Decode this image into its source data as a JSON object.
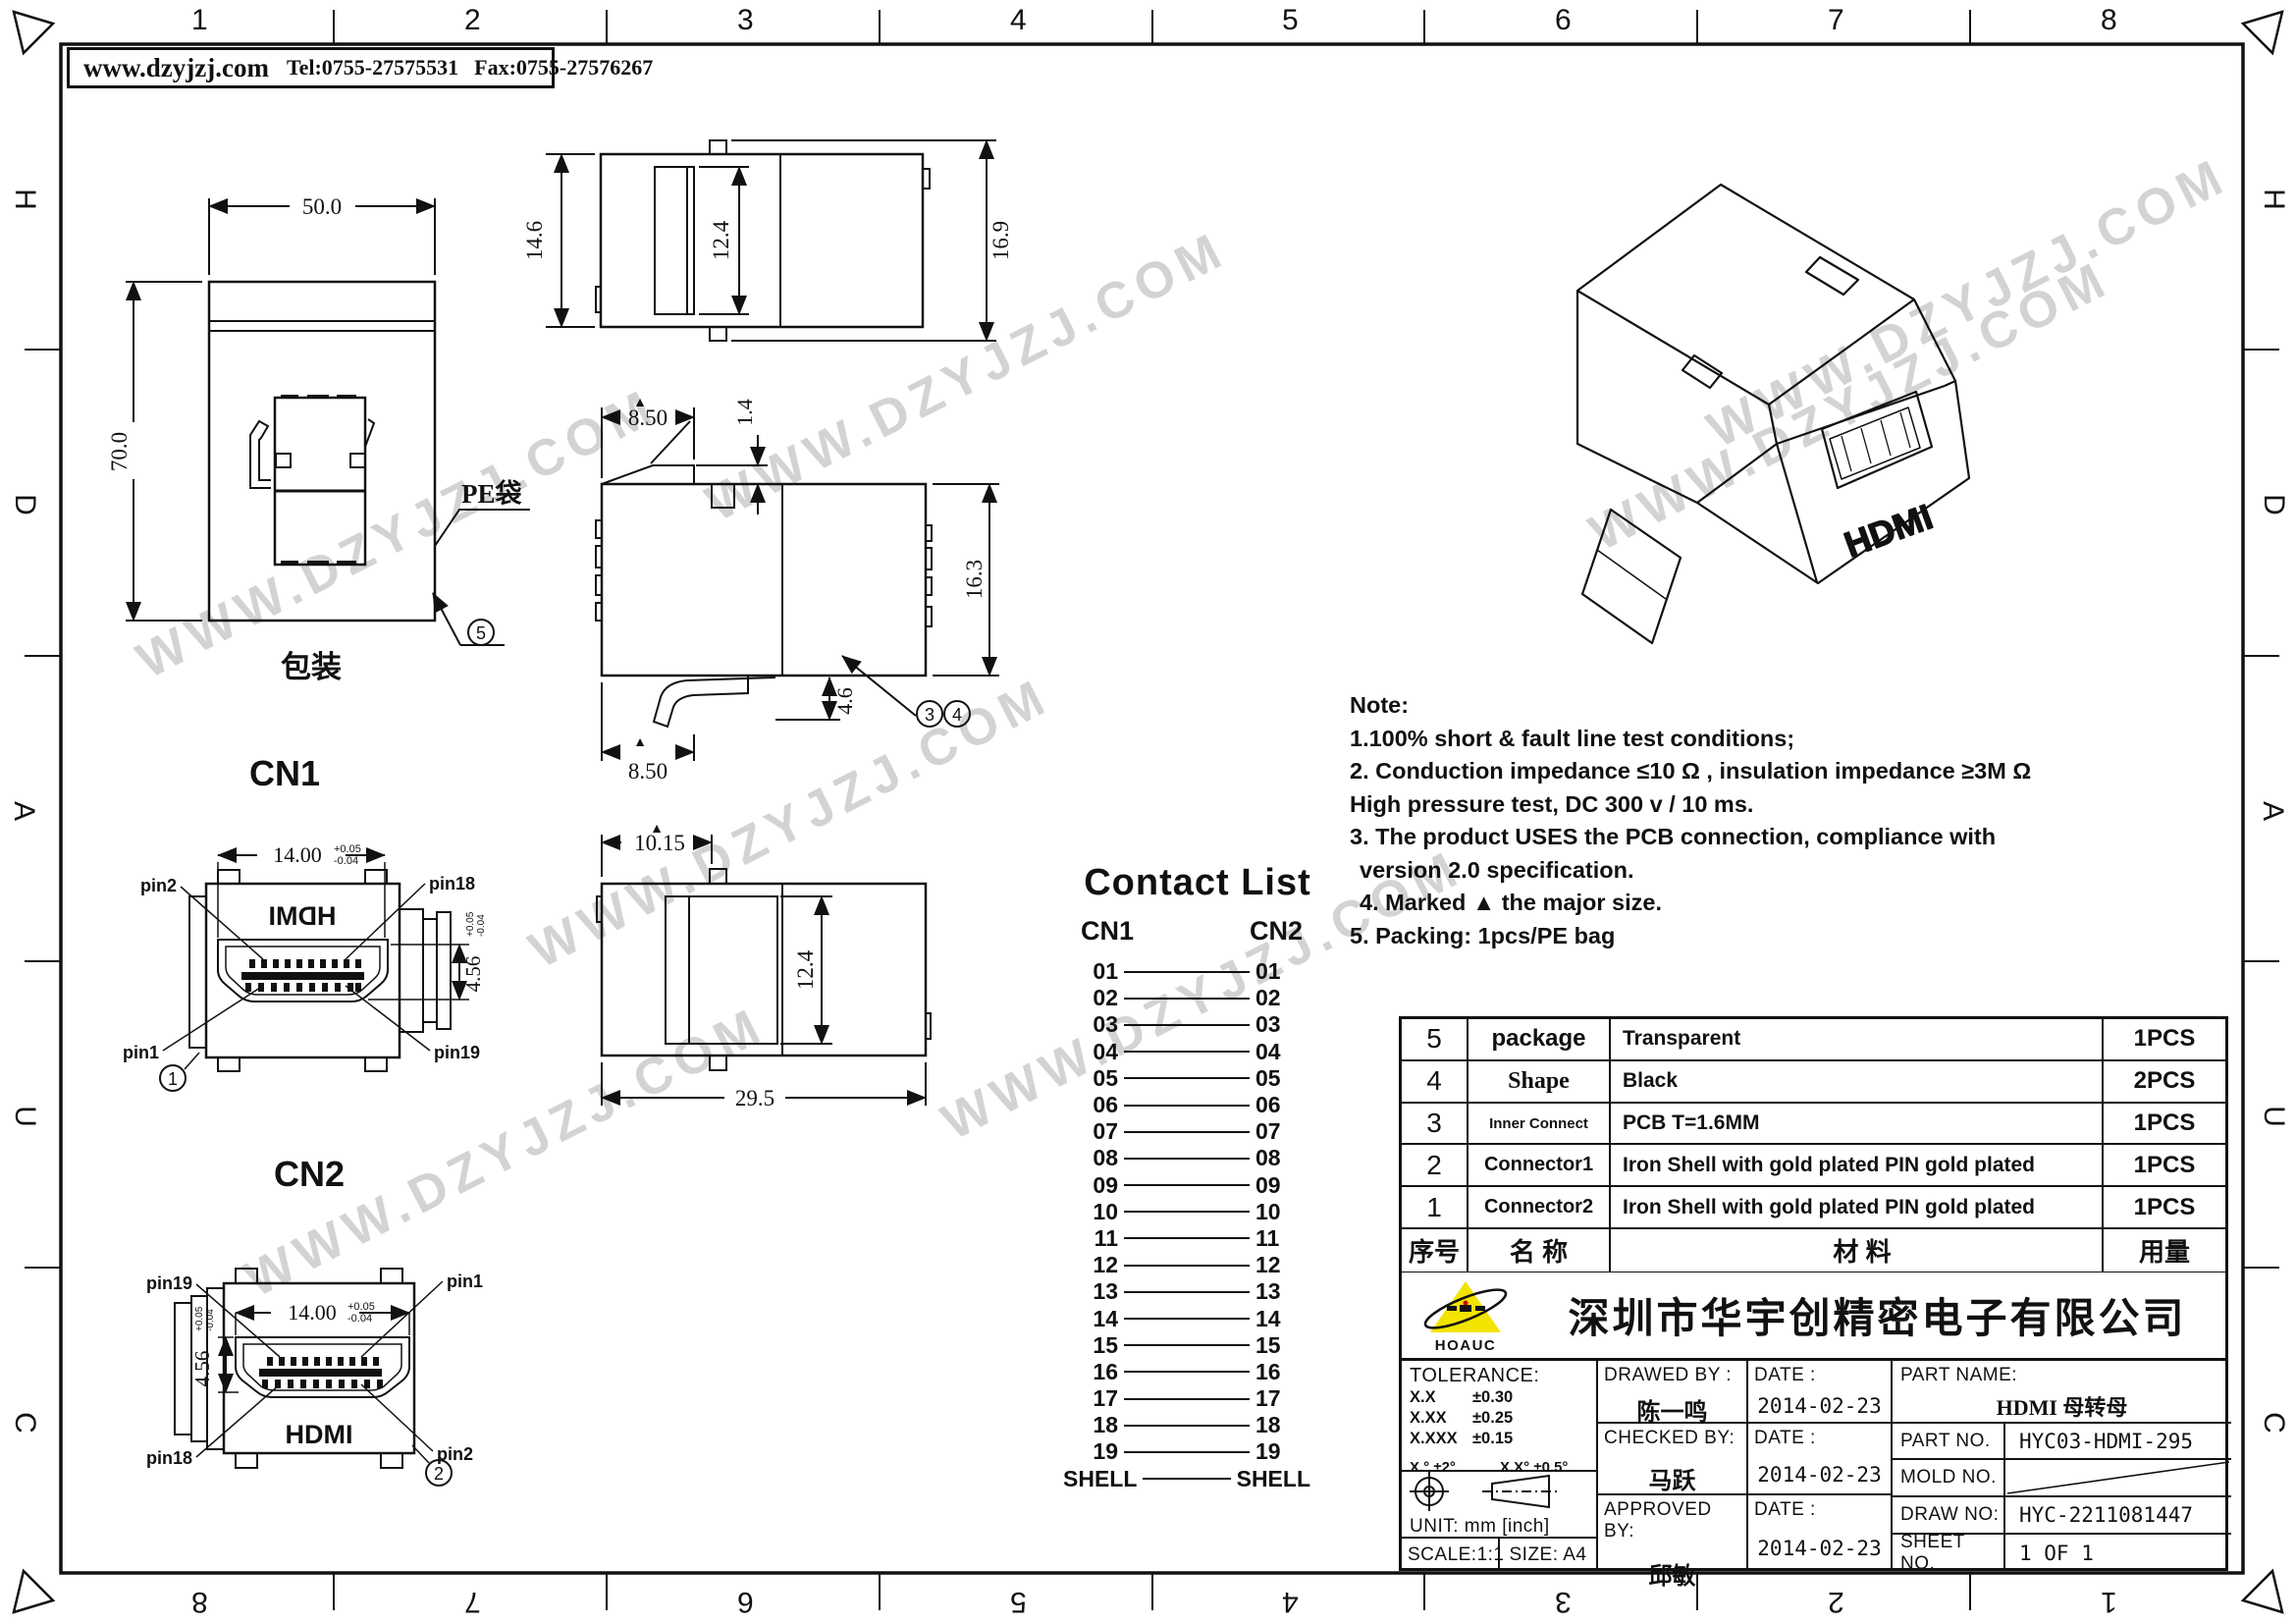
{
  "header": {
    "website": "www.dzyjzj.com",
    "tel": "Tel:0755-27575531",
    "fax": "Fax:0755-27576267"
  },
  "border": {
    "top": [
      "1",
      "2",
      "3",
      "4",
      "5",
      "6",
      "7",
      "8"
    ],
    "bottom": [
      "8",
      "7",
      "6",
      "5",
      "4",
      "3",
      "2",
      "1"
    ],
    "left": [
      "H",
      "D",
      "A",
      "U",
      "C"
    ],
    "right": [
      "H",
      "D",
      "A",
      "U",
      "C"
    ]
  },
  "watermark": {
    "text": "WWW.DZYJZJ.COM"
  },
  "views": {
    "packaging": {
      "caption": "包装",
      "bag_label": "PE袋",
      "dim_width": "50.0",
      "dim_height": "70.0",
      "balloon": "5"
    },
    "top_view": {
      "dim_height": "14.6",
      "dim_slot": "12.4",
      "dim_total": "16.9"
    },
    "side_view": {
      "dim_top": "8.50",
      "dim_notch": "1.4",
      "dim_height": "16.3",
      "dim_latch": "4.6",
      "dim_bottom": "8.50",
      "marker": "▲",
      "balloon_a": "3",
      "balloon_b": "4"
    },
    "bottom_view": {
      "dim_top": "10.15",
      "dim_slot": "12.4",
      "dim_width": "29.5",
      "marker": "▲"
    },
    "cn1": {
      "title": "CN1",
      "logo": "HDMI",
      "dim_width": "14.00",
      "dim_height": "4.56",
      "tol_up": "+0.05",
      "tol_dn": "-0.04",
      "pin_tl": "pin2",
      "pin_tr": "pin18",
      "pin_bl": "pin1",
      "pin_br": "pin19",
      "balloon": "1"
    },
    "cn2": {
      "title": "CN2",
      "logo": "HDMI",
      "dim_width": "14.00",
      "dim_height": "4.56",
      "tol_up": "+0.05",
      "tol_dn": "-0.04",
      "pin_tl": "pin19",
      "pin_tr": "pin1",
      "pin_bl": "pin18",
      "pin_br": "pin2",
      "balloon": "2"
    },
    "iso": {
      "logo": "HDMI"
    }
  },
  "contact_list": {
    "title": "Contact List",
    "col_left": "CN1",
    "col_right": "CN2",
    "rows": [
      "01",
      "02",
      "03",
      "04",
      "05",
      "06",
      "07",
      "08",
      "09",
      "10",
      "11",
      "12",
      "13",
      "14",
      "15",
      "16",
      "17",
      "18",
      "19",
      "SHELL"
    ]
  },
  "notes": {
    "line0": "Note:",
    "line1": "1.100% short & fault line test conditions;",
    "line2": "2. Conduction impedance ≤10 Ω , insulation impedance ≥3M Ω",
    "line3": "High pressure test, DC 300 v / 10 ms.",
    "line4": "3. The product USES the PCB connection, compliance with",
    "line5": "version 2.0 specification.",
    "line6": "4. Marked ▲ the major size.",
    "line7": "5. Packing: 1pcs/PE bag"
  },
  "bom": {
    "header": {
      "no": "序号",
      "name": "名 称",
      "material": "材 料",
      "qty": "用量"
    },
    "rows": [
      {
        "no": "5",
        "name": "package",
        "material": "Transparent",
        "qty": "1PCS"
      },
      {
        "no": "4",
        "name": "Shape",
        "material": "Black",
        "qty": "2PCS"
      },
      {
        "no": "3",
        "name": "Inner Connect",
        "material": "PCB T=1.6MM",
        "qty": "1PCS"
      },
      {
        "no": "2",
        "name": "Connector1",
        "material": "Iron Shell with gold plated PIN gold plated",
        "qty": "1PCS"
      },
      {
        "no": "1",
        "name": "Connector2",
        "material": "Iron Shell with gold plated PIN gold plated",
        "qty": "1PCS"
      }
    ]
  },
  "title_block": {
    "company": "深圳市华宇创精密电子有限公司",
    "logo_text": "HOAUC",
    "tolerance_title": "TOLERANCE:",
    "tol1": "X.X",
    "tol1v": "±0.30",
    "tol2": "X.XX",
    "tol2v": "±0.25",
    "tol3": "X.XXX",
    "tol3v": "±0.15",
    "tol_ang1": "X.° ±2°",
    "tol_ang2": "X.X° ±0.5°",
    "unit": "UNIT: mm [inch]",
    "scale": "SCALE:1:1",
    "size": "SIZE: A4",
    "drawed_label": "DRAWED BY :",
    "drawed": "陈一鸣",
    "checked_label": "CHECKED BY:",
    "checked": "马跃",
    "approved_label": "APPROVED BY:",
    "approved": "邱敏",
    "date_label": "DATE :",
    "date1": "2014-02-23",
    "date2": "2014-02-23",
    "date3": "2014-02-23",
    "part_name_label": "PART NAME:",
    "part_name": "HDMI 母转母",
    "part_no_label": "PART NO.",
    "part_no": "HYC03-HDMI-295",
    "mold_label": "MOLD NO.",
    "draw_label": "DRAW NO:",
    "draw_no": "HYC-2211081447",
    "sheet_label": "SHEET NO.",
    "sheet_no": "1 OF 1"
  }
}
